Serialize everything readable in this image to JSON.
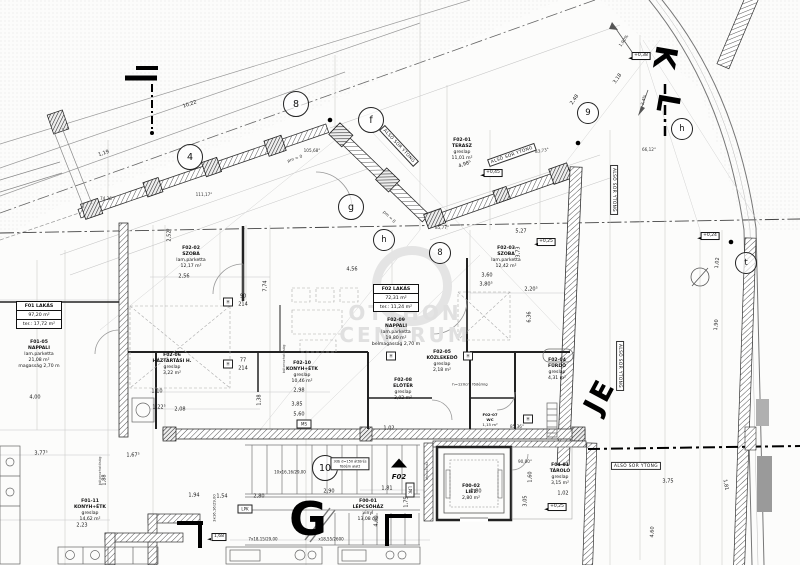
{
  "watermark": {
    "line1": "OTTHON",
    "line2": "CENTRUM"
  },
  "street_labels": {
    "s0": "ALSÓ SOR YTONG",
    "s1": "ALSÓ SOR YTONG",
    "s2": "ALSÓ SOR YTONG",
    "s3": "ALSÓ SOR YTONG",
    "s4": "ALSÓ SOR YTONG"
  },
  "apartments": {
    "f01": {
      "title": "F01 LAKÁS",
      "area": "97,20 m²",
      "terrace": "ter.: 17,72 m²"
    },
    "f02": {
      "title": "F02 LAKÁS",
      "area": "72,31 m²",
      "terrace": "ter.: 11,24 m²"
    }
  },
  "rooms": [
    {
      "id": "F01-05",
      "name": "NAPPALI",
      "finish": "lam.parketta",
      "area": "21,08 m²",
      "note": "magasság 2,70 m"
    },
    {
      "id": "F02-09",
      "name": "NAPPALI",
      "finish": "lam.parketta",
      "area": "19,80 m²",
      "note": "belmagasság 2,70 m"
    },
    {
      "id": "F02-02",
      "name": "SZOBA",
      "finish": "lam.parketta",
      "area": "12,17 m²"
    },
    {
      "id": "F02-03",
      "name": "SZOBA",
      "finish": "lam.parketta",
      "area": "12,42 m²"
    },
    {
      "id": "F02-01",
      "name": "TERASZ",
      "finish": "greslap",
      "area": "11,01 m²"
    },
    {
      "id": "F02-05",
      "name": "KÖZLEKEDŐ",
      "finish": "greslap",
      "area": "2,18 m²"
    },
    {
      "id": "F02-04",
      "name": "FÜRDŐ",
      "finish": "greslap",
      "area": "4,31 m²"
    },
    {
      "id": "F02-06",
      "name": "HÁZTARTÁSI H.",
      "finish": "greslap",
      "area": "3,22 m²"
    },
    {
      "id": "F02-10",
      "name": "KONYH+ÉTK",
      "finish": "greslap",
      "area": "10,46 m²"
    },
    {
      "id": "F02-08",
      "name": "ELŐTÉR",
      "finish": "greslap",
      "area": "3,02 m²"
    },
    {
      "id": "F02-07",
      "name": "WC",
      "finish": "greslap",
      "area": "1,15 m²"
    },
    {
      "id": "F00-02",
      "name": "LIFT",
      "area": "2,80 m²"
    },
    {
      "id": "F00-01",
      "name": "LÉPCSŐHÁZ",
      "finish": "vinyl",
      "area": "13,08 m²"
    },
    {
      "id": "F04-01",
      "name": "TÁROLÓ",
      "finish": "greslap",
      "area": "3,15 m²"
    },
    {
      "id": "F01-11",
      "name": "KONYH+ÉTK",
      "finish": "greslap",
      "area": "14,62 m²"
    }
  ],
  "axis_markers": [
    "4",
    "8",
    "f",
    "g",
    "h",
    "8",
    "9",
    "h",
    "10",
    "t"
  ],
  "big_letters": {
    "k": "K",
    "l": "L",
    "je": "JE",
    "g": "G"
  },
  "entrance": {
    "label": "F02"
  },
  "levels": [
    "+0,45",
    "+0,25",
    "+0,38",
    "+0,24",
    "+0,25"
  ],
  "icons": {
    "level_flag": "◄"
  },
  "angles": [
    "111,17°",
    "74,26°",
    "105,68°",
    "66,12°",
    "83,73°",
    "85,77°",
    "85,36°",
    "90,00°"
  ],
  "slopes": [
    "1,90%",
    "2,4%",
    "pm = 0",
    "pm = 0"
  ],
  "notes": {
    "piercing_line1": "3db d=150 áttörés",
    "piercing_line2": "födém alatt",
    "lintel": "h=120cm födémig",
    "stairs_top": "10x16,16/29,00",
    "stairs_bottom": "7x18,15/29,00",
    "stairs_side": "3x16,16/29,00",
    "stairs_mid": "x18,55/2600",
    "lift_clear": "1,68"
  },
  "markers": {
    "h": "H",
    "ms": "MS",
    "lpk": "LPK"
  },
  "vertical_texts": {
    "furnishability": "bútorozhatóság",
    "stairwell": "lépcsőház"
  },
  "dims": [
    "4,56",
    "2,56",
    "7,74",
    "90",
    "214",
    "5,27",
    "3,73",
    "3,60",
    "3,80⁵",
    "2,20⁵",
    "6,36",
    "1,02",
    "1,81",
    "1,75",
    "4,60",
    "1,80",
    "1,60",
    "1,02",
    "3,05",
    "1,02",
    "1,90",
    "3,18",
    "2,48",
    "3,75",
    "4,60",
    "1,81",
    "10,22",
    "1,19",
    "2,23",
    "3,77⁵",
    "1,67⁵",
    "1,88",
    "2,08",
    "1,10",
    "2,98",
    "3,85",
    "5,60",
    "2,90",
    "1,94",
    "2,52⁵",
    "4,98⁵",
    "4,00",
    "1,22⁵",
    "1,38",
    "77",
    "214",
    "1,54",
    "2,80"
  ]
}
